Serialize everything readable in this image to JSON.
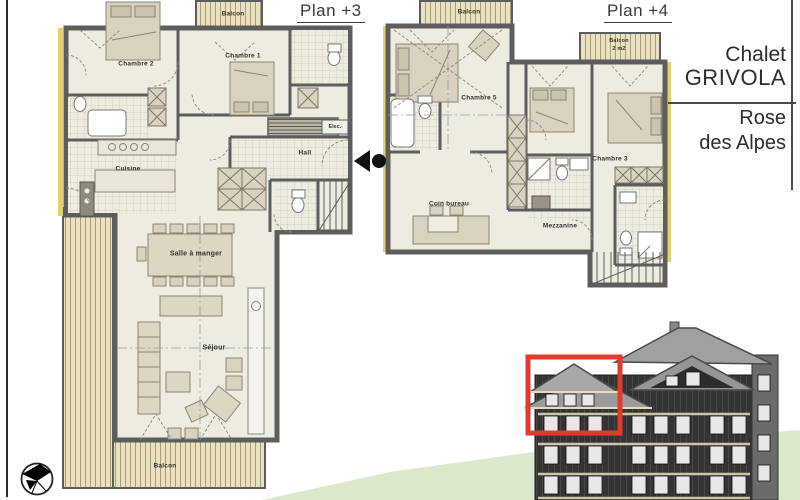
{
  "titles": {
    "plan3": "Plan +3",
    "plan4": "Plan +4"
  },
  "title_block": {
    "chalet": [
      "Chalet",
      "GRIVOLA"
    ],
    "residence": [
      "Rose",
      "des Alpes"
    ]
  },
  "plan3": {
    "labels": {
      "balcon_top": "Balcon",
      "chambre2": "Chambre 2",
      "chambre1": "Chambre 1",
      "cuisine": "Cuisine",
      "hall": "Hall",
      "elec": "Elec.",
      "salle_a_manger": "Salle à manger",
      "sejour": "Séjour",
      "balcon_bottom": "Balcon"
    }
  },
  "plan4": {
    "labels": {
      "balcon_top": "Balcon",
      "balcon_small_line1": "Balcon",
      "balcon_small_line2": "2 m2",
      "chambre5": "Chambre 5",
      "chambre3": "Chambre 3",
      "coin_bureau": "Coin bureau",
      "mezzanine": "Mezzanine"
    }
  },
  "icons": {
    "north_arrow": "north-arrow-compass",
    "section_marker": "section-cut-marker"
  },
  "colors": {
    "highlight_red": "#e23a2c",
    "wall": "#5d5d5d",
    "wood_deck": "#eae1bf",
    "grass": "#dce8cb"
  }
}
